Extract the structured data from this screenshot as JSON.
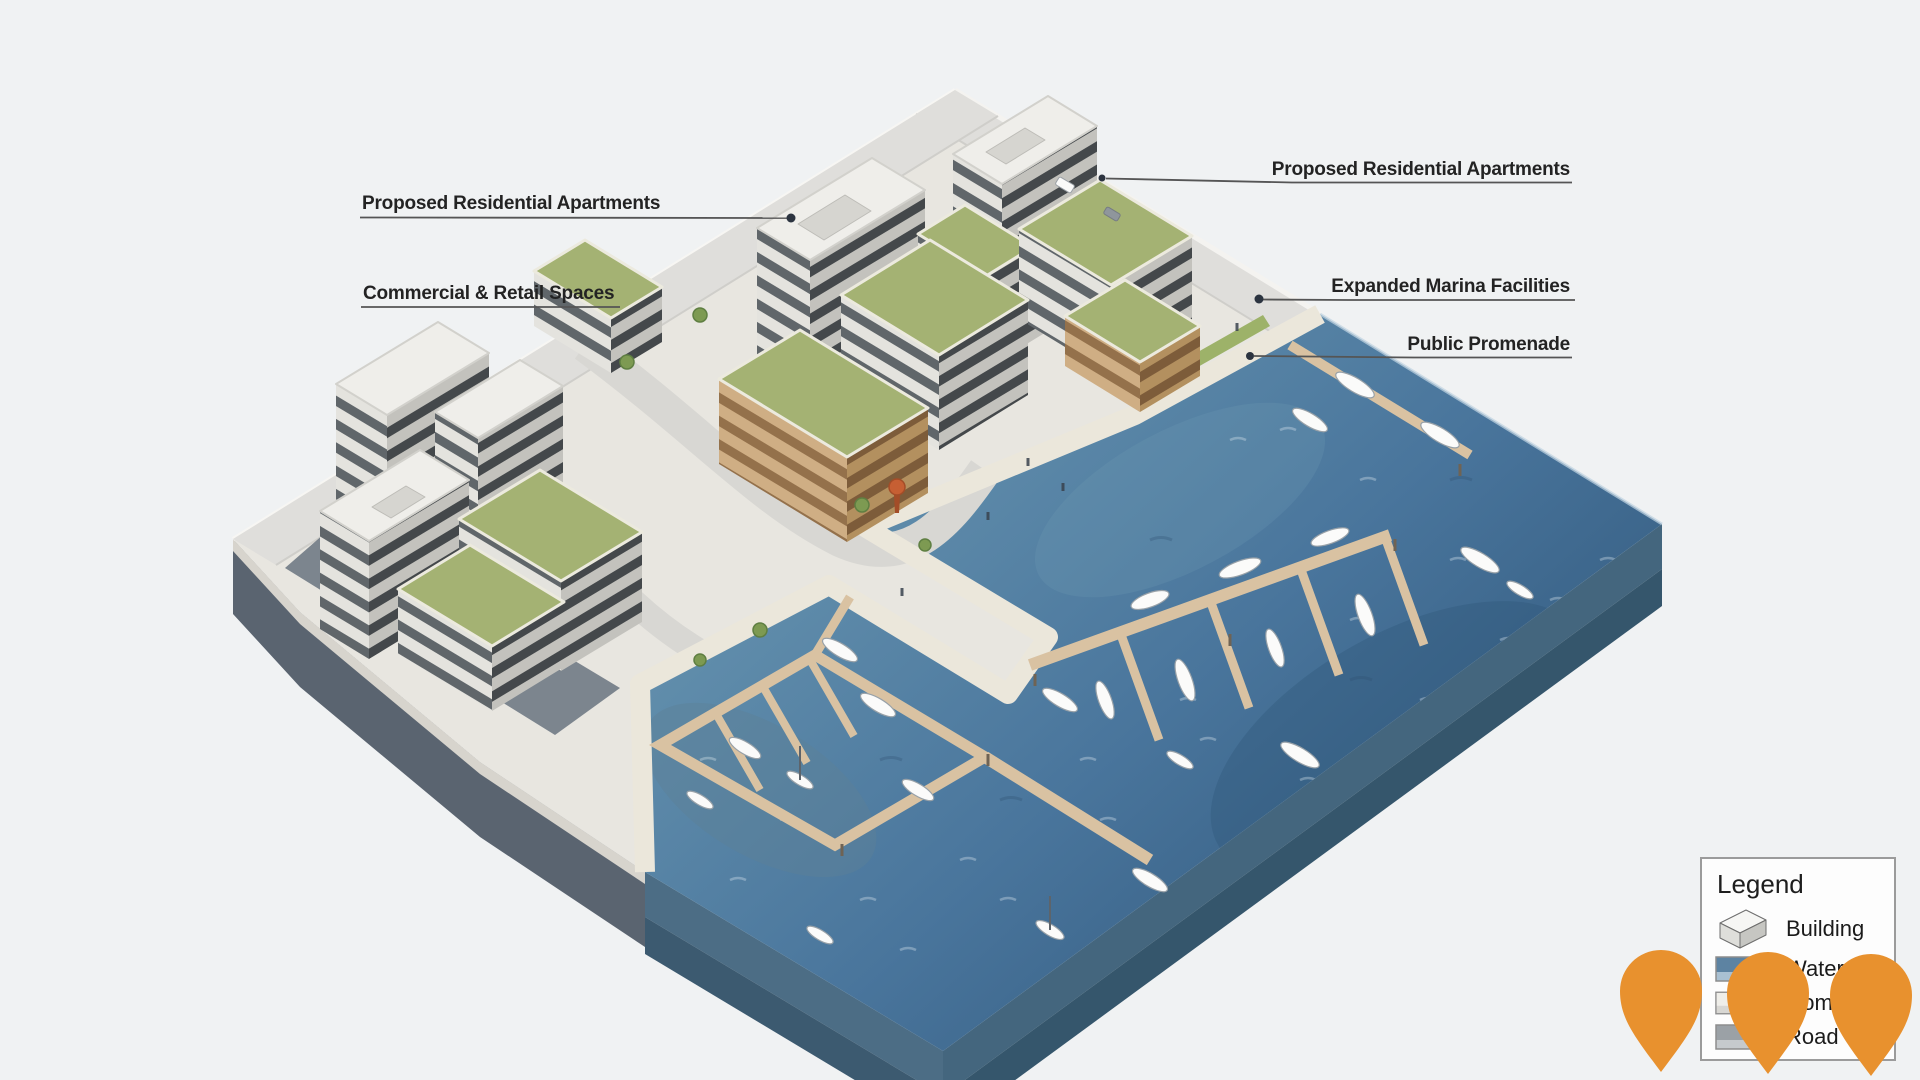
{
  "annotations": {
    "left": [
      {
        "id": "residential-left",
        "label": "Proposed Residential Apartments"
      },
      {
        "id": "commercial-retail",
        "label": "Commercial & Retail Spaces"
      }
    ],
    "right": [
      {
        "id": "residential-right",
        "label": "Proposed Residential Apartments"
      },
      {
        "id": "marina",
        "label": "Expanded Marina Facilities"
      },
      {
        "id": "promenade",
        "label": "Public Promenade"
      }
    ]
  },
  "legend": {
    "title": "Legend",
    "items": [
      {
        "label": "Building",
        "icon": "building-iso-icon"
      },
      {
        "label": "Water",
        "color": "#5d83a2",
        "color2": "#a9c0d2"
      },
      {
        "label": "Promenade",
        "color": "#efeee9",
        "color2": "#d8d7d3"
      },
      {
        "label": "Road",
        "color": "#9ba1a6",
        "color2": "#c6cacd"
      }
    ]
  },
  "pins": {
    "color": "#e8912e",
    "count": 3
  },
  "palette": {
    "background": "#f0f2f3",
    "water": "#49759c",
    "waterDeep": "#335a7d",
    "waterEdge": "#44667e",
    "land": "#e8e6e0",
    "plinth": "#5a6470",
    "promenade": "#ebe7db",
    "road": "#dfdedb",
    "dock": "#d9c2a2",
    "greenRoof": "#a4b273",
    "buildingRoof": "#efeeea"
  }
}
